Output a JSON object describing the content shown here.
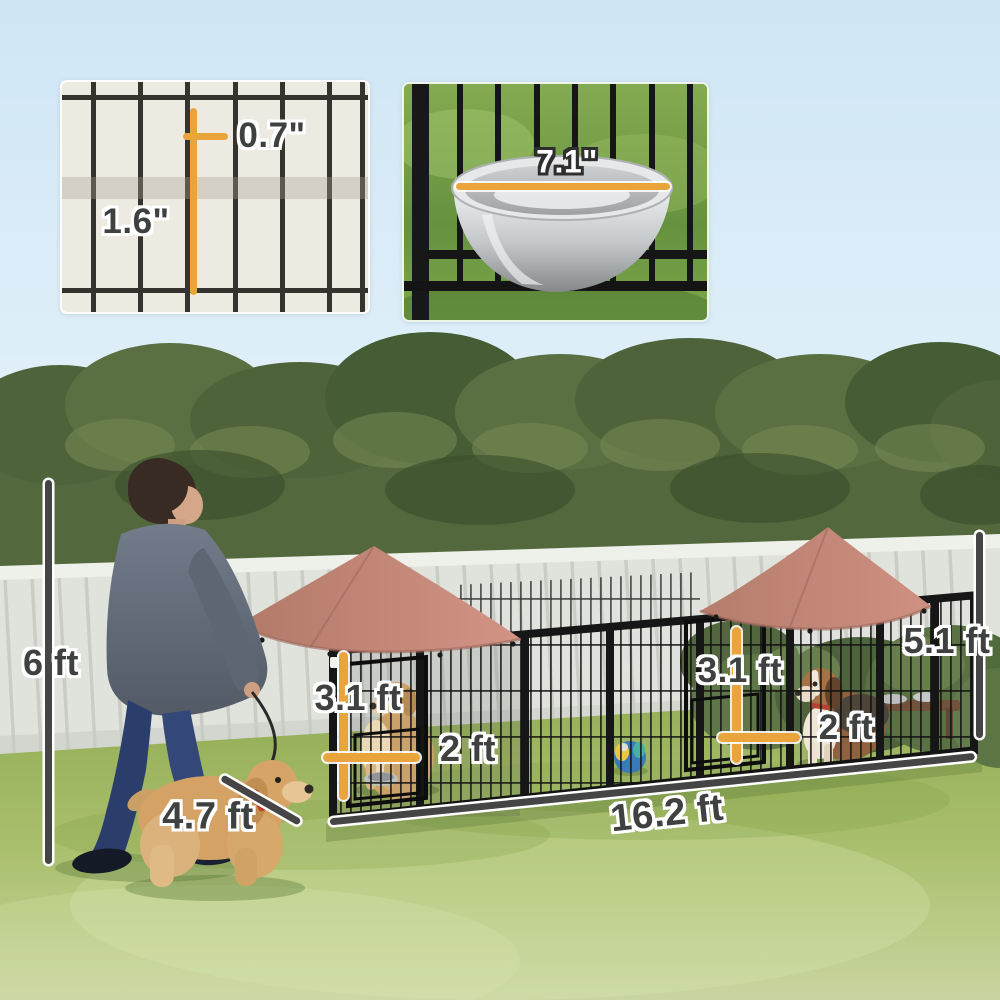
{
  "insets": {
    "mesh_detail": {
      "width_label": "0.7\"",
      "height_label": "1.6\""
    },
    "bowl_detail": {
      "diameter_label": "7.1\""
    }
  },
  "measurements": {
    "fence_height": "6 ft",
    "walking_dog_length": "4.7 ft",
    "left_door_height": "3.1 ft",
    "left_door_width": "2 ft",
    "right_door_height": "3.1 ft",
    "right_door_width": "2 ft",
    "kennel_height": "5.1 ft",
    "kennel_length": "16.2 ft"
  },
  "colors": {
    "measure_orange": "#E9A43C",
    "measure_dark": "#454545",
    "canopy": "#C5897B",
    "label_text": "#3F4040"
  }
}
